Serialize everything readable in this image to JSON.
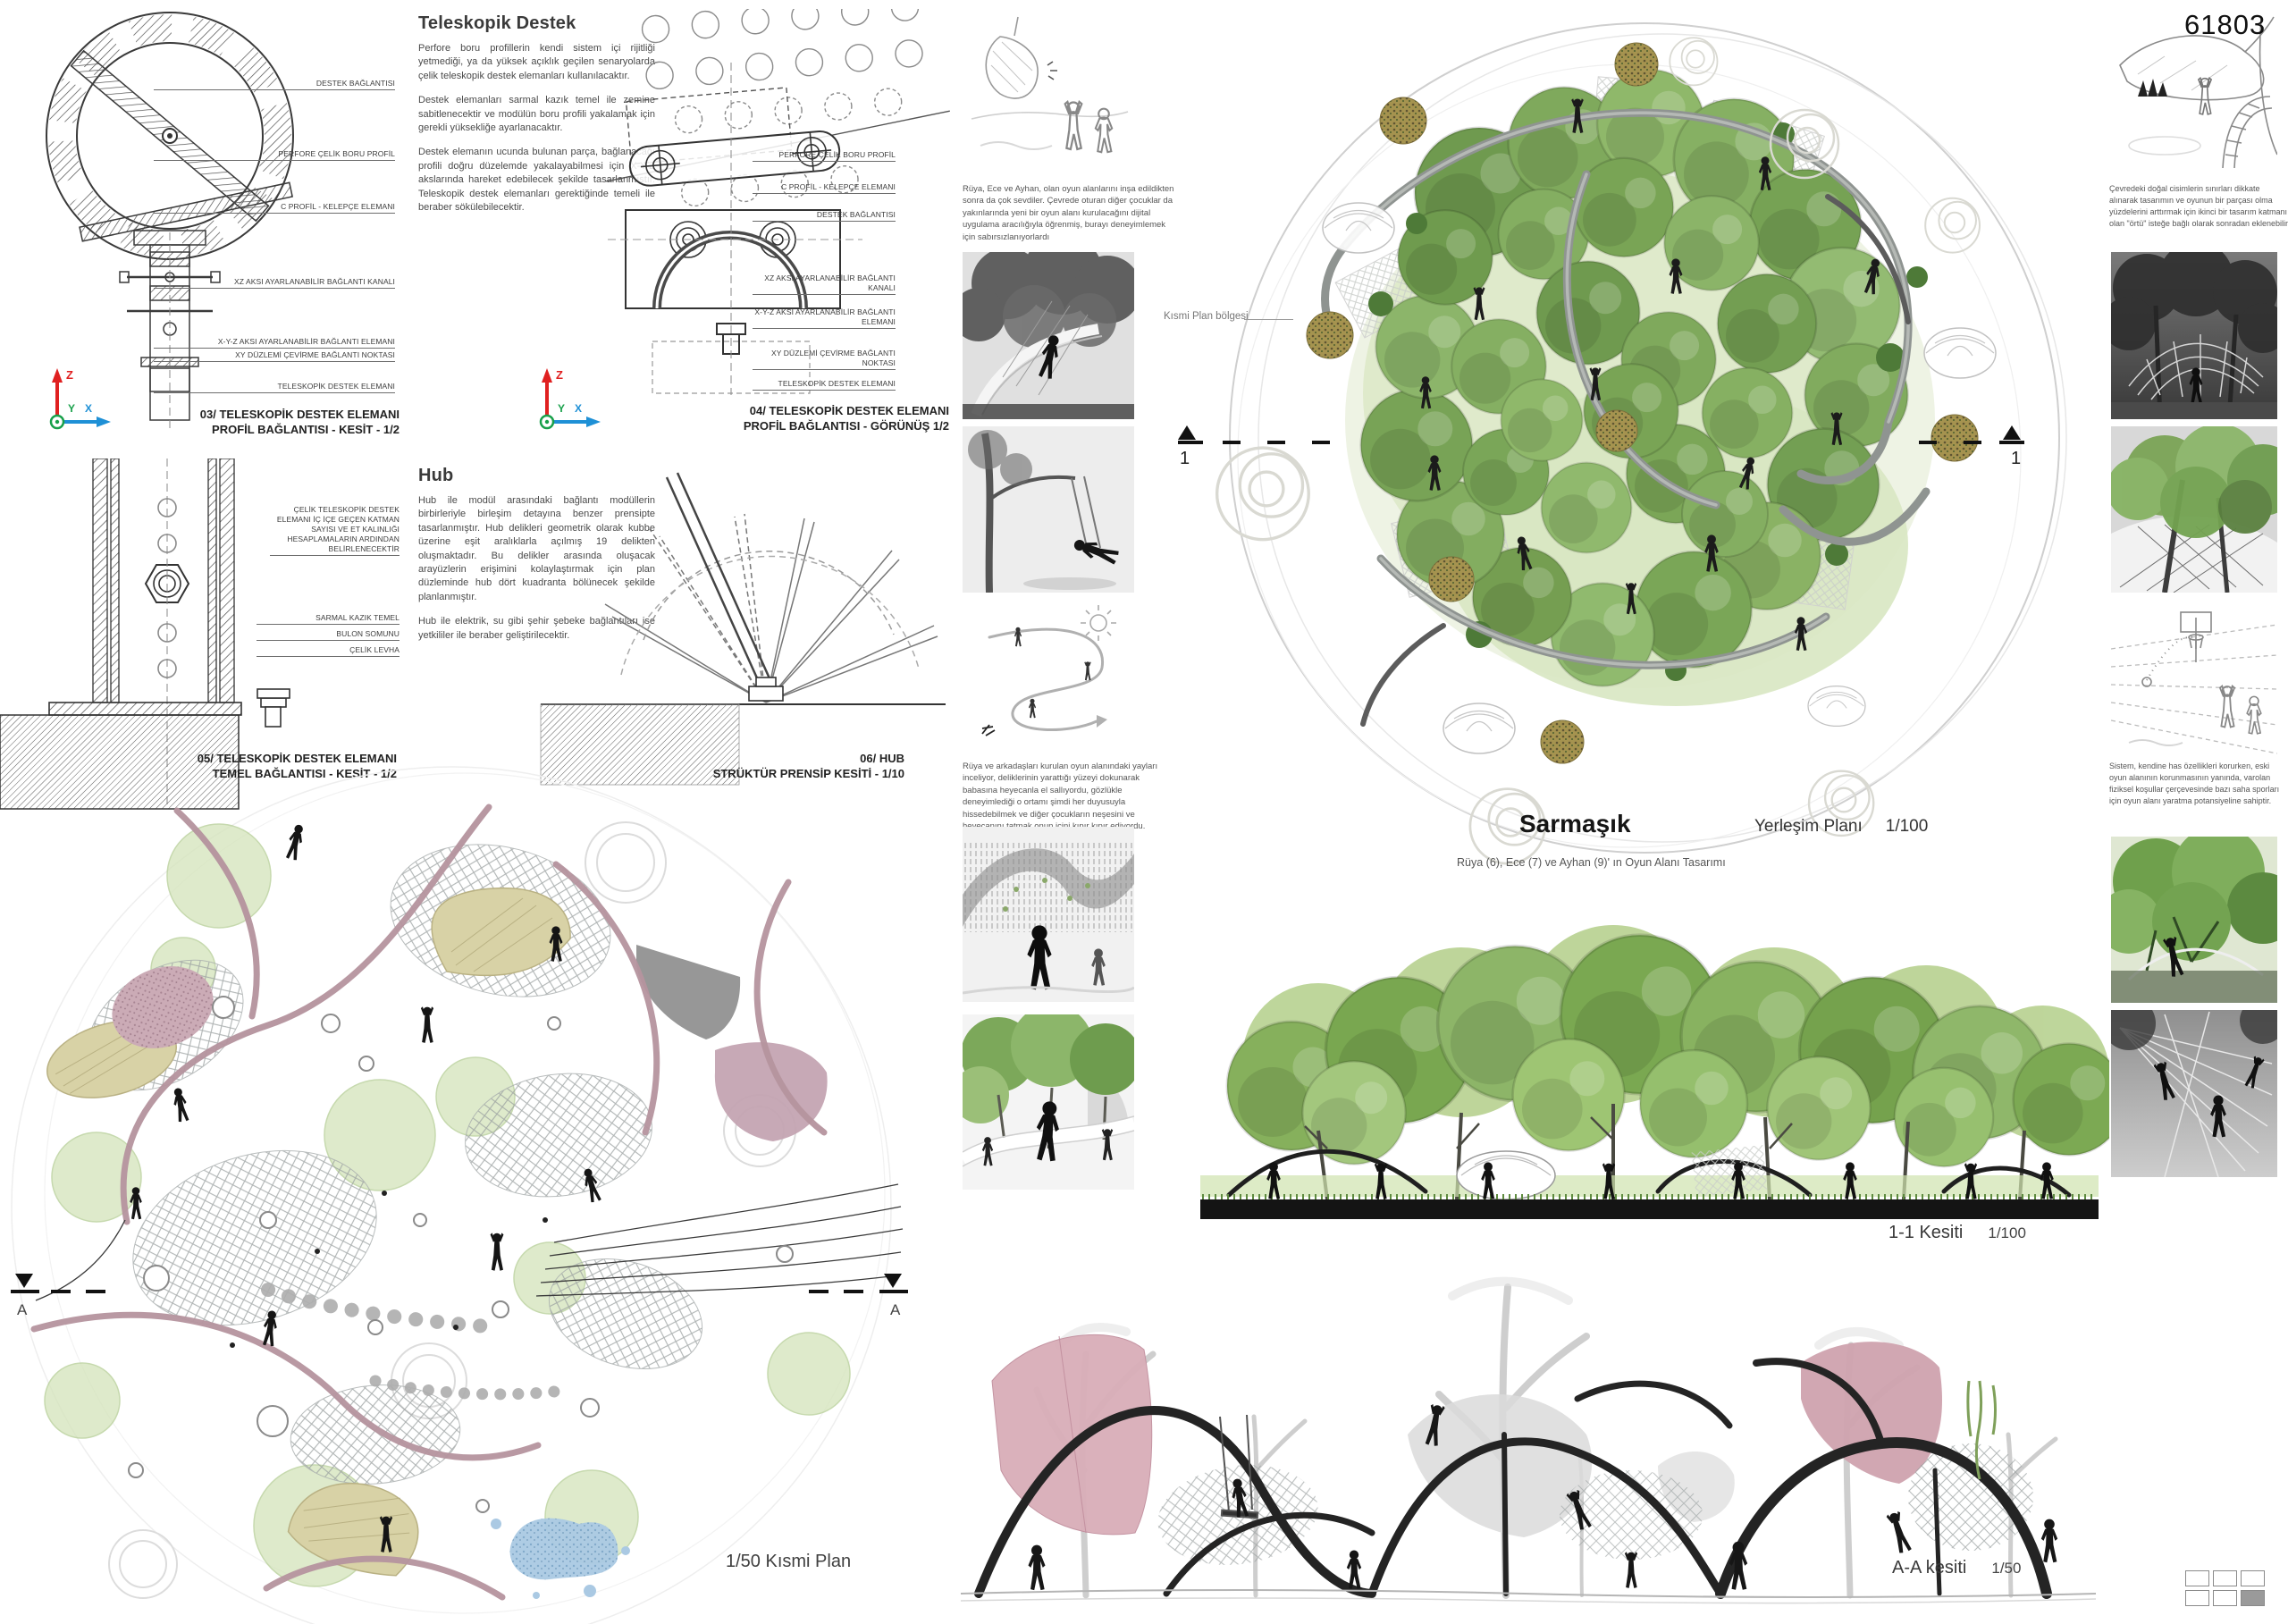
{
  "board": {
    "number": "61803",
    "project_title": "Sarmaşık",
    "project_subtitle": "Rüya (6), Ece (7) ve Ayhan (9)' ın Oyun Alanı Tasarımı"
  },
  "axis": {
    "x": "X",
    "y": "Y",
    "z": "Z"
  },
  "texts": {
    "teleskopik": {
      "title": "Teleskopik Destek",
      "p1": "Perfore boru profillerin kendi sistem içi rijitliği yetmediği, ya da yüksek açıklık geçilen senaryolarda çelik teleskopik destek elemanları kullanılacaktır.",
      "p2": "Destek elemanları sarmal kazık temel ile zemine sabitlenecektir ve modülün boru profili yakalamak için gerekli yüksekliğe ayarlanacaktır.",
      "p3": "Destek elemanın ucunda bulunan parça, bağlanacağı profili doğru düzelemde yakalayabilmesi için X-Y-Z akslarında hareket edebilecek şekilde tasarlanmıştır. Teleskopik destek elemanları gerektiğinde temeli ile beraber sökülebilecektir."
    },
    "hub": {
      "title": "Hub",
      "p1": "Hub ile modül arasındaki bağlantı modüllerin birbirleriyle birleşim detayına benzer prensipte tasarlanmıştır. Hub delikleri geometrik olarak kubbe üzerine eşit aralıklarla açılmış 19 delikten oluşmaktadır. Bu delikler arasında oluşacak arayüzlerin erişimini kolaylaştırmak için plan düzleminde hub dört kuadranta bölünecek şekilde planlanmıştır.",
      "p2": "Hub ile elektrik, su gibi şehir şebeke bağlantıları ise yetkililer ile beraber geliştirilecektir."
    }
  },
  "details": {
    "d03": {
      "labels": [
        "DESTEK BAĞLANTISI",
        "PERFORE ÇELİK BORU PROFİL",
        "C PROFİL - KELEPÇE ELEMANI",
        "XZ AKSI AYARLANABİLİR BAĞLANTI KANALI",
        "X-Y-Z AKSI AYARLANABİLİR BAĞLANTI ELEMANI",
        "XY DÜZLEMİ ÇEVİRME BAĞLANTI NOKTASI",
        "TELESKOPİK DESTEK ELEMANI"
      ],
      "caption1": "03/ TELESKOPİK DESTEK ELEMANI",
      "caption2": "PROFİL BAĞLANTISI - KESİT - 1/2"
    },
    "d04": {
      "labels": [
        "PERFORE ÇELİK BORU PROFİL",
        "C PROFİL - KELEPÇE ELEMANI",
        "DESTEK BAĞLANTISI",
        "XZ AKSI AYARLANABİLİR BAĞLANTI KANALI",
        "X-Y-Z AKSI AYARLANABİLİR BAĞLANTI ELEMANI",
        "XY DÜZLEMİ ÇEVİRME BAĞLANTI NOKTASI",
        "TELESKOPİK DESTEK ELEMANI"
      ],
      "caption1": "04/ TELESKOPİK DESTEK ELEMANI",
      "caption2": "PROFİL BAĞLANTISI - GÖRÜNÜŞ 1/2"
    },
    "d05": {
      "labels": [
        "ÇELİK TELESKOPİK DESTEK ELEMANI İÇ İÇE GEÇEN KATMAN SAYISI VE ET KALINLIĞI HESAPLAMALARIN ARDINDAN BELİRLENECEKTİR",
        "SARMAL KAZIK TEMEL",
        "BULON SOMUNU",
        "ÇELİK LEVHA"
      ],
      "caption1": "05/ TELESKOPİK DESTEK ELEMANI",
      "caption2": "TEMEL BAĞLANTISI - KESİT - 1/2"
    },
    "d06": {
      "caption1": "06/ HUB",
      "caption2": "STRÜKTÜR PRENSİP KESİTİ - 1/10"
    }
  },
  "site_plan": {
    "region_label": "Kısmi Plan bölgesi",
    "marker": "1",
    "plan_label": "Yerleşim Planı",
    "plan_scale": "1/100"
  },
  "partial_plan": {
    "caption": "1/50 Kısmi Plan",
    "marker": "A"
  },
  "sections": {
    "s11_label": "1-1 Kesiti",
    "s11_scale": "1/100",
    "aa_label": "A-A kesiti",
    "aa_scale": "1/50"
  },
  "story": {
    "caption1": "Rüya, Ece ve Ayhan, olan oyun alanlarını inşa edildikten sonra da çok sevdiler. Çevrede oturan diğer çocuklar da yakınlarında yeni bir oyun alanı kurulacağını dijital uygulama aracılığıyla öğrenmiş, burayı deneyimlemek için sabırsızlanıyorlardı",
    "caption2": "Rüya ve arkadaşları kurulan oyun alanındaki yayları inceliyor, deliklerinin yarattığı yüzeyi dokunarak babasına heyecanla el sallıyordu, gözlükle deneyimlediği o ortamı şimdi her duyusuyla hissedebilmek ve diğer çocukların neşesini ve heyecanını tatmak onun içini kıpır kıpır ediyordu."
  },
  "right_notes": {
    "caption1": "Çevredeki doğal cisimlerin sınırları dikkate alınarak tasarımın ve oyunun bir parçası olma yüzdelerini arttırmak için ikinci bir tasarım katmanı olan \"örtü\" isteğe bağlı olarak sonradan eklenebilir",
    "caption2": "Sistem, kendine has özellikleri korurken, eski oyun alanının korunmasının yanında, varolan fiziksel koşullar çerçevesinde bazı saha sporları için oyun alanı yaratma potansiyeline sahiptir."
  },
  "colors": {
    "canopy_green": "#7fa95c",
    "ground_green": "#d6e6c0",
    "tube_gray": "#8f9491",
    "pink_membrane": "#c9a7b2",
    "beige_blob": "#d8d2a6",
    "water_blue": "#aac9e3",
    "axis_red": "#e02020",
    "axis_blue": "#1e90d6",
    "axis_green": "#18a04a",
    "ink": "#2a2a2a"
  }
}
